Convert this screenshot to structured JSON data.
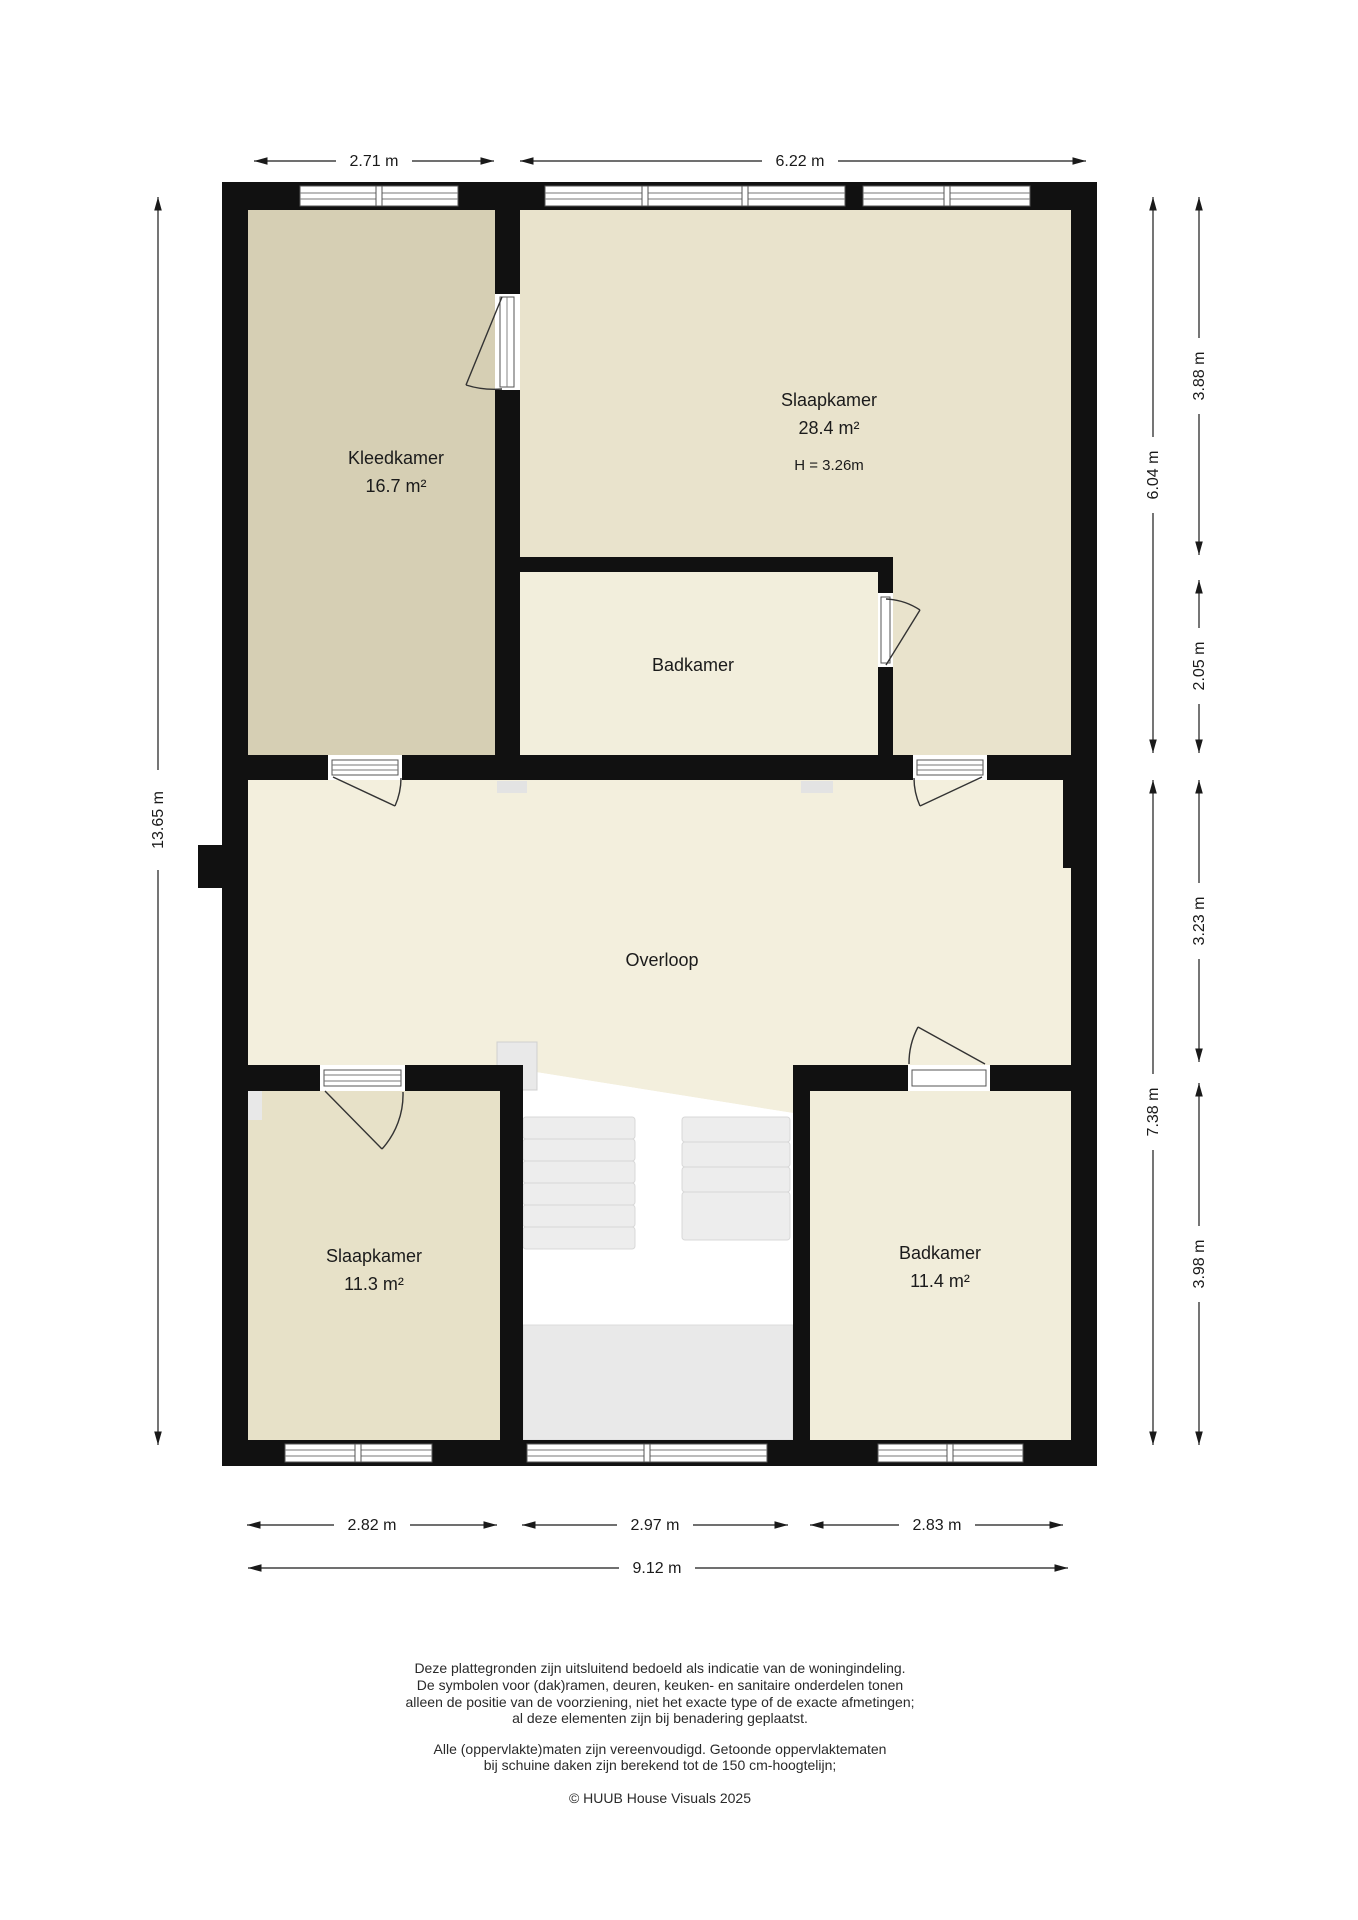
{
  "rooms": [
    {
      "name": "Kleedkamer",
      "area": "16.7 m²"
    },
    {
      "name": "Slaapkamer",
      "area": "28.4 m²",
      "height": "H = 3.26m"
    },
    {
      "name": "Badkamer"
    },
    {
      "name": "Overloop"
    },
    {
      "name": "Slaapkamer",
      "area": "11.3 m²"
    },
    {
      "name": "Badkamer",
      "area": "11.4 m²"
    }
  ],
  "dimensions": {
    "top": [
      "2.71 m",
      "6.22 m"
    ],
    "left": [
      "13.65 m"
    ],
    "right_inner": [
      "6.04 m",
      "7.38 m"
    ],
    "right_outer": [
      "3.88 m",
      "2.05 m",
      "3.23 m",
      "3.98 m"
    ],
    "bottom": [
      "2.82 m",
      "2.97 m",
      "2.83 m"
    ],
    "bottom_total": "9.12 m"
  },
  "colors": {
    "wall": "#111111",
    "kleedkamer": "#d6cfb4",
    "slaapkamer_top": "#e9e3cc",
    "badkamer_top": "#f2eedc",
    "overloop": "#f3efdd",
    "slaapkamer_bottom": "#e7e1c8",
    "badkamer_bottom": "#f1edda",
    "stairs": "#ededed",
    "landing": "#e9e9e9",
    "void": "#ffffff"
  },
  "footer": {
    "lines": [
      "Deze plattegronden zijn uitsluitend bedoeld als indicatie van de woningindeling.",
      "De symbolen voor (dak)ramen, deuren, keuken- en sanitaire onderdelen tonen",
      "alleen de positie van de voorziening, niet het exacte type of de exacte afmetingen;",
      "al deze elementen zijn bij benadering geplaatst.",
      "Alle (oppervlakte)maten zijn vereenvoudigd. Getoonde oppervlaktematen",
      "bij schuine daken zijn berekend tot de 150 cm-hoogtelijn;"
    ],
    "copyright": "© HUUB House Visuals 2025"
  }
}
